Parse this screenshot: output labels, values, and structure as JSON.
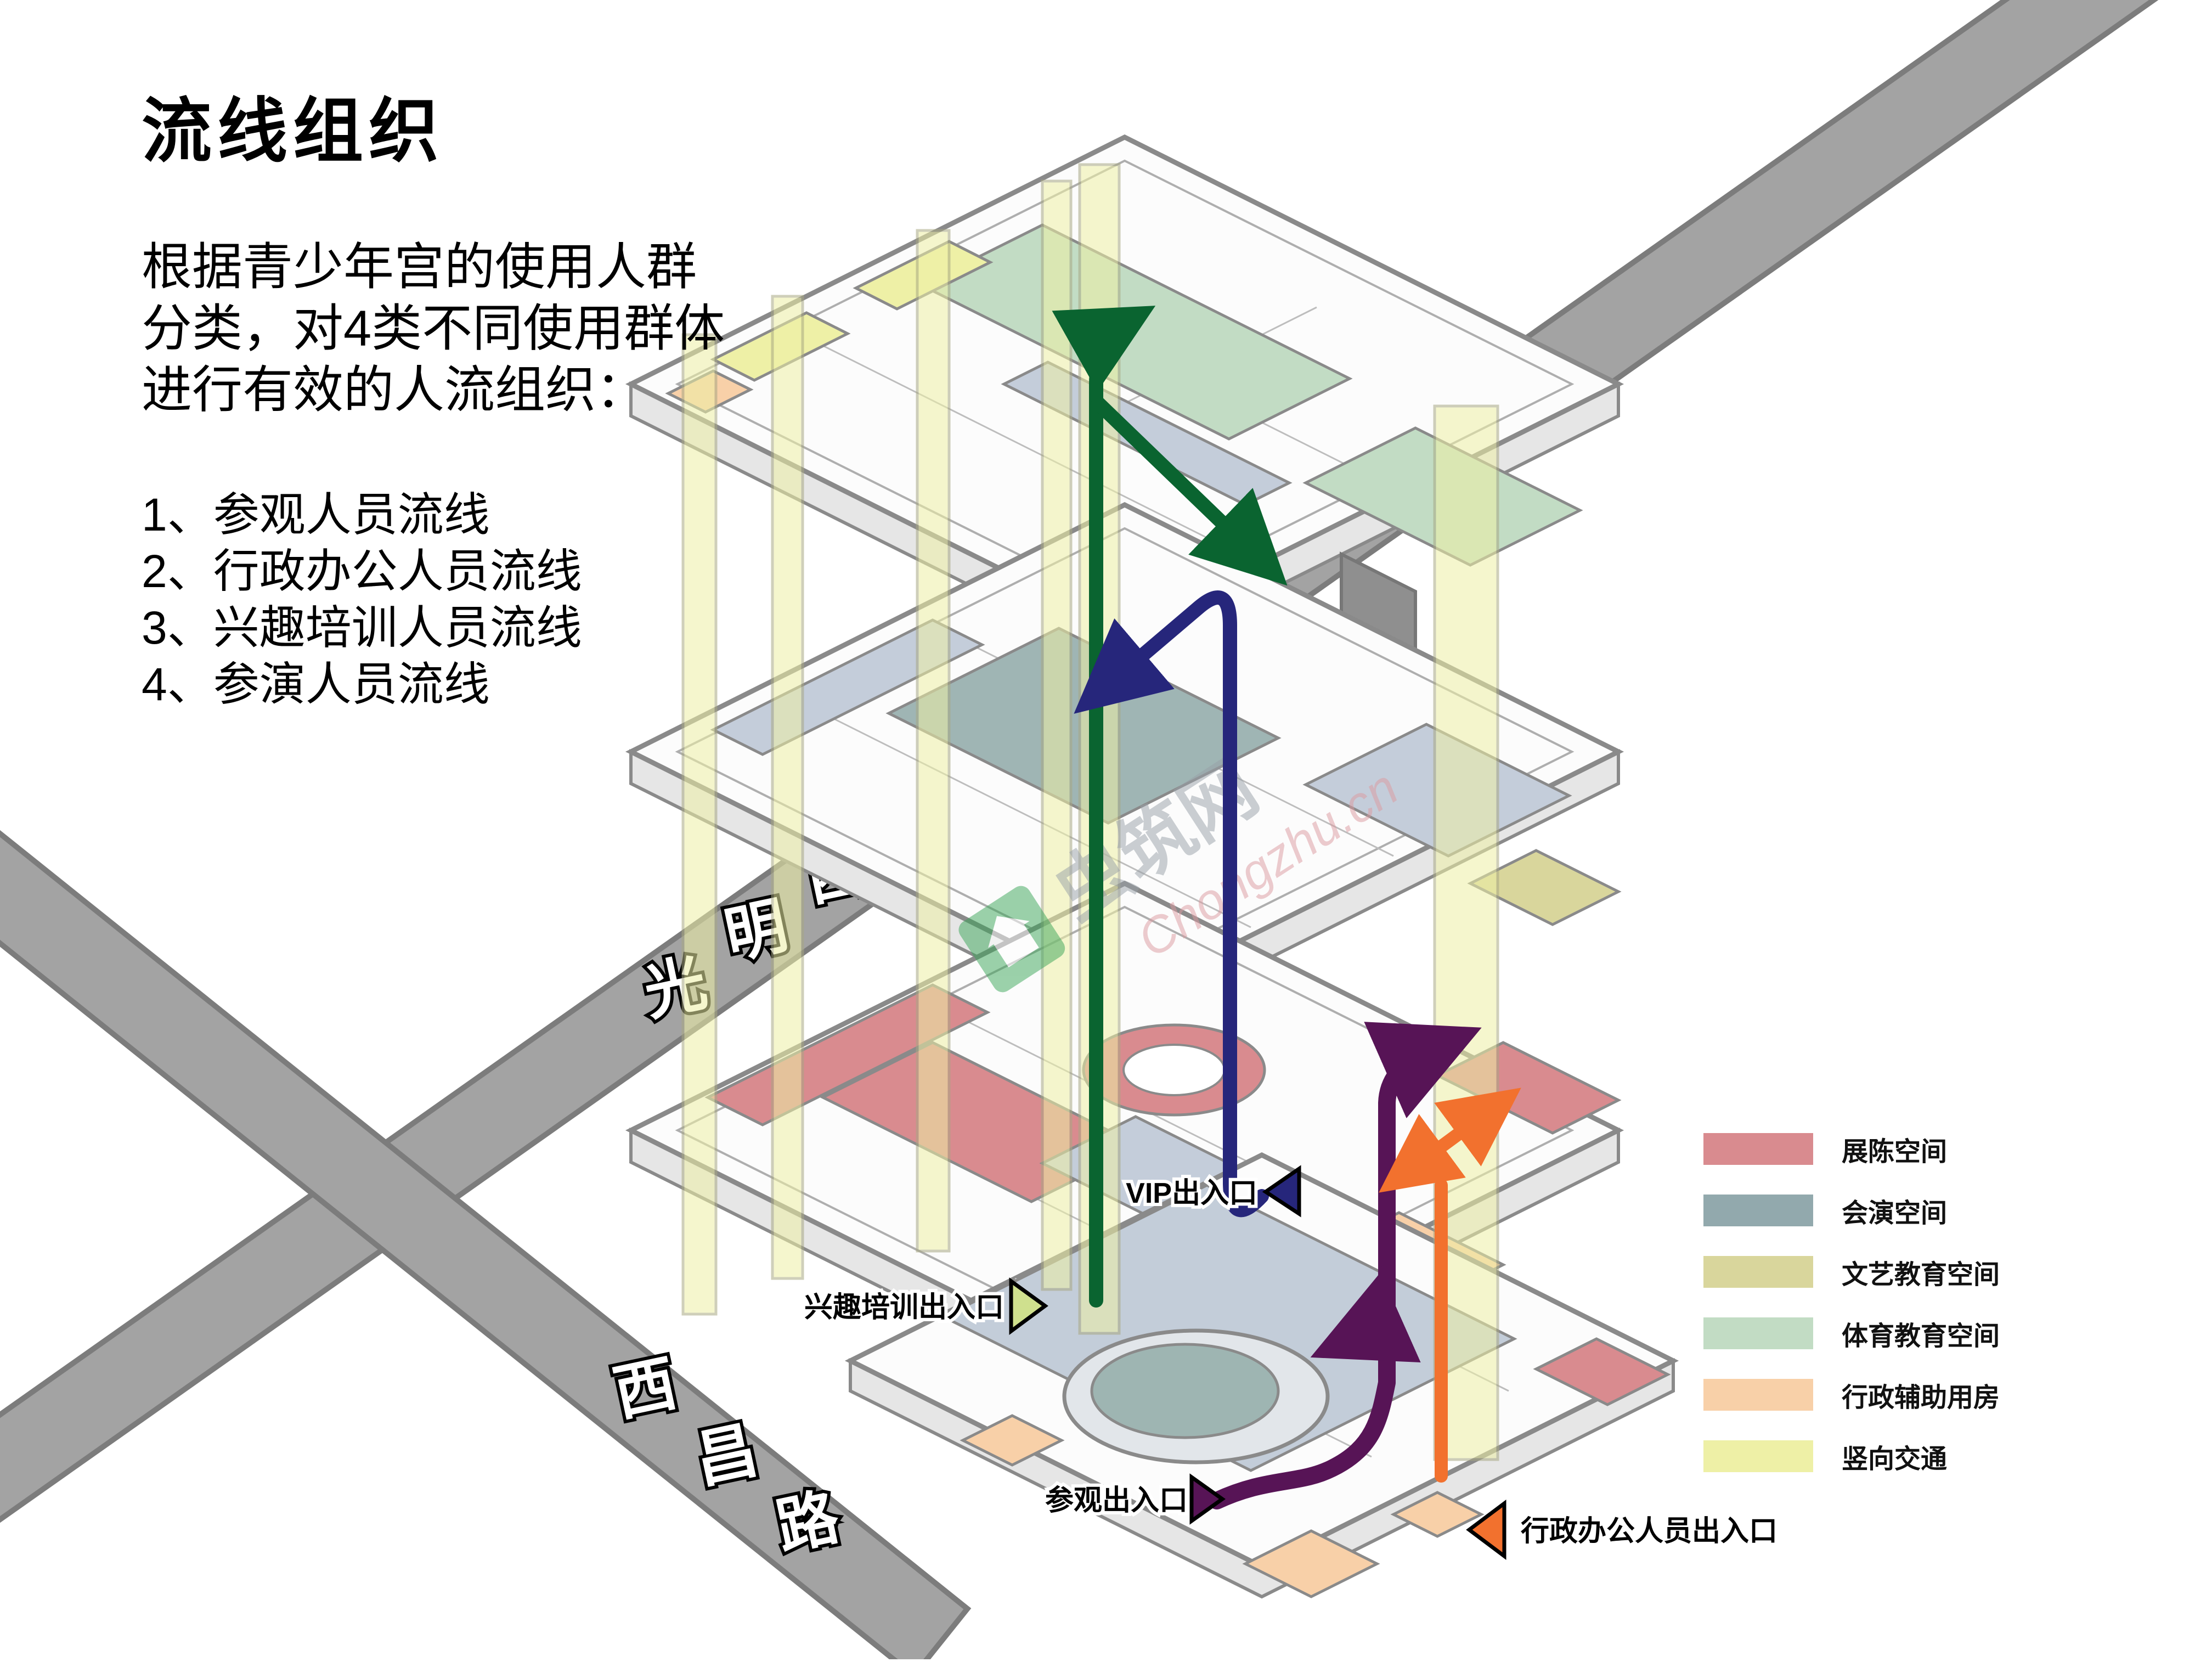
{
  "page": {
    "title": "流线组织"
  },
  "intro": {
    "lines": [
      "根据青少年宫的使用人群",
      "分类，对4类不同使用群体",
      "进行有效的人流组织："
    ]
  },
  "list": {
    "items": [
      "1、参观人员流线",
      "2、行政办公人员流线",
      "3、兴趣培训人员流线",
      "4、参演人员流线"
    ]
  },
  "roads": {
    "guangming": {
      "name": "光明西道",
      "chars": [
        "光",
        "明",
        "西",
        "道"
      ],
      "fill": "#a3a3a3",
      "edge": "#7c7c7c"
    },
    "xichang": {
      "name": "西昌路",
      "chars": [
        "西",
        "昌",
        "路"
      ],
      "fill": "#a3a3a3",
      "edge": "#7c7c7c"
    }
  },
  "flows": {
    "visitor": {
      "name": "参观人员流线",
      "color": "#571456"
    },
    "admin": {
      "name": "行政办公人员流线",
      "color": "#f2712e"
    },
    "interest": {
      "name": "兴趣培训人员流线",
      "color": "#0a6430"
    },
    "performer": {
      "name": "参演人员流线",
      "color": "#26267b"
    }
  },
  "entrances": {
    "interest": {
      "label": "兴趣培训出入口",
      "color": "#cfe08e"
    },
    "vip": {
      "label": "VIP出入口",
      "color": "#26267b"
    },
    "visitor": {
      "label": "参观出入口",
      "color": "#571456"
    },
    "admin": {
      "label": "行政办公人员出入口",
      "color": "#f2712e"
    }
  },
  "legend": {
    "items": [
      {
        "label": "展陈空间",
        "color": "#d98b8f"
      },
      {
        "label": "会演空间",
        "color": "#92a9ad"
      },
      {
        "label": "文艺教育空间",
        "color": "#d9d69c"
      },
      {
        "label": "体育教育空间",
        "color": "#c2dcc4"
      },
      {
        "label": "行政辅助用房",
        "color": "#f8d0a8"
      },
      {
        "label": "竖向交通",
        "color": "#eef0a6"
      }
    ]
  },
  "watermark": {
    "site": "虫筑网",
    "url": "Chongzhu.cn"
  },
  "building": {
    "colors": {
      "corridor": "#c4cdda",
      "plaza": "#c3cdd9",
      "auditorium": "#9fb5b4",
      "oval_ring": "#e2e6ea",
      "oval_core": "#9eb5b2",
      "tunnel": "#8f8f8f"
    }
  }
}
